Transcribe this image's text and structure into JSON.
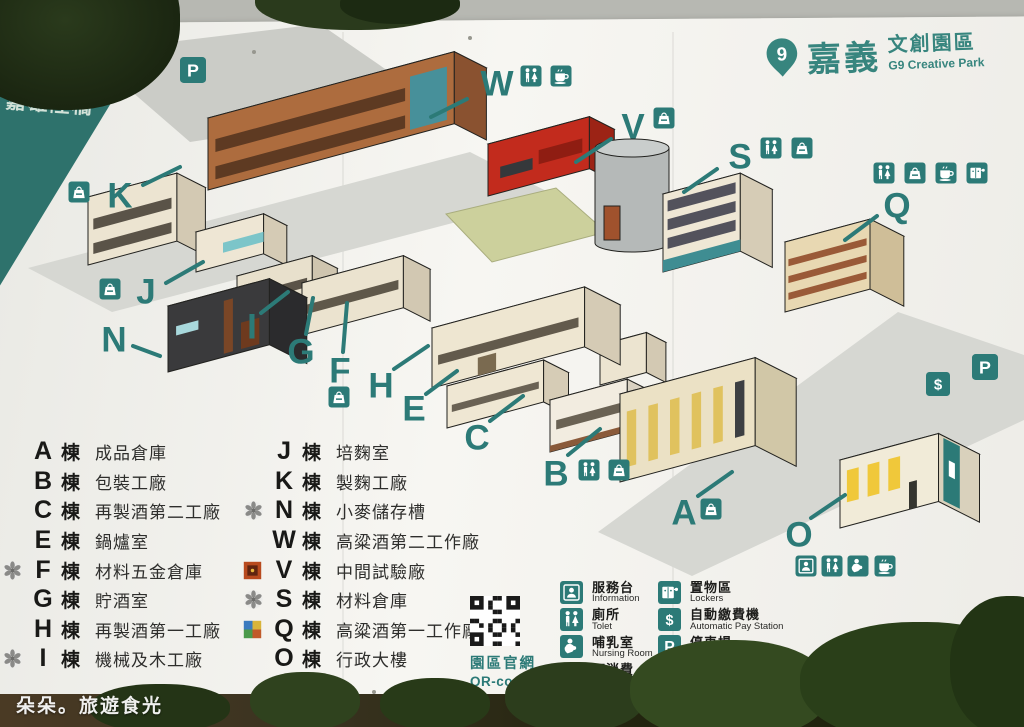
{
  "photo": {
    "watermark": "朵朵。旅遊食光"
  },
  "banners": {
    "left": "嘉雄陸橋",
    "right": "嘉義車站"
  },
  "logo": {
    "zh": "嘉義",
    "type_zh": "文創園區",
    "en": "G9 Creative Park",
    "pin_digit": "9"
  },
  "qr": {
    "zh": "園區官網",
    "en": "QR-code"
  },
  "colors": {
    "teal": "#2c7a77",
    "banner_left": "#2e726c",
    "banner_right": "#1e6f6a",
    "board": "#f4f3ef"
  },
  "legend": {
    "suffix": "棟",
    "col1": [
      {
        "letter": "A",
        "name": "成品倉庫",
        "stamp": null
      },
      {
        "letter": "B",
        "name": "包裝工廠",
        "stamp": null
      },
      {
        "letter": "C",
        "name": "再製酒第二工廠",
        "stamp": null
      },
      {
        "letter": "E",
        "name": "鍋爐室",
        "stamp": null
      },
      {
        "letter": "F",
        "name": "材料五金倉庫",
        "stamp": "flower"
      },
      {
        "letter": "G",
        "name": "貯酒室",
        "stamp": null
      },
      {
        "letter": "H",
        "name": "再製酒第一工廠",
        "stamp": null
      },
      {
        "letter": "I",
        "name": "機械及木工廠",
        "stamp": "flower"
      }
    ],
    "col2": [
      {
        "letter": "J",
        "name": "培麴室",
        "stamp": null
      },
      {
        "letter": "K",
        "name": "製麴工廠",
        "stamp": null
      },
      {
        "letter": "N",
        "name": "小麥儲存槽",
        "stamp": "flower"
      },
      {
        "letter": "W",
        "name": "高粱酒第二工作廠",
        "stamp": null
      },
      {
        "letter": "V",
        "name": "中間試驗廠",
        "stamp": "art_red"
      },
      {
        "letter": "S",
        "name": "材料倉庫",
        "stamp": "flower"
      },
      {
        "letter": "Q",
        "name": "高粱酒第一工作廠",
        "stamp": "art_color"
      },
      {
        "letter": "O",
        "name": "行政大樓",
        "stamp": null
      }
    ]
  },
  "facilities": {
    "col1": [
      {
        "icon": "info",
        "zh": "服務台",
        "en": "Information"
      },
      {
        "icon": "toilet",
        "zh": "廁所",
        "en": "Tolet"
      },
      {
        "icon": "nursing",
        "zh": "哺乳室",
        "en": "Nursing Room"
      },
      {
        "icon": "bag",
        "zh": "可消費",
        "en": "Consumable"
      }
    ],
    "col2": [
      {
        "icon": "locker",
        "zh": "置物區",
        "en": "Lockers"
      },
      {
        "icon": "dollar",
        "zh": "自動繳費機",
        "en": "Automatic Pay Station"
      },
      {
        "icon": "parking",
        "zh": "停車場",
        "en": "Parking Lot"
      },
      {
        "icon": "cup",
        "zh": "茶水間",
        "en": "Tea Room"
      }
    ]
  },
  "map": {
    "roads": [
      {
        "name": "parking-area-top-left",
        "c": "#cbccc7",
        "pts": [
          [
            86,
            52
          ],
          [
            320,
            24
          ],
          [
            436,
            104
          ],
          [
            190,
            142
          ]
        ]
      },
      {
        "name": "road-upper",
        "c": "#d6d7d2",
        "pts": [
          [
            28,
            268
          ],
          [
            470,
            152
          ],
          [
            556,
            196
          ],
          [
            112,
            312
          ]
        ]
      },
      {
        "name": "road-lower-right",
        "c": "#d6d7d2",
        "pts": [
          [
            598,
            532
          ],
          [
            898,
            312
          ],
          [
            1024,
            355
          ],
          [
            1024,
            420
          ],
          [
            692,
            576
          ]
        ]
      }
    ],
    "lawns": [
      {
        "name": "lawn-center",
        "c": "#ccd09c",
        "pts": [
          [
            446,
            214
          ],
          [
            556,
            188
          ],
          [
            606,
            232
          ],
          [
            492,
            262
          ]
        ]
      },
      {
        "name": "lawn-left",
        "c": "#ccd09c",
        "pts": [
          [
            120,
            210
          ],
          [
            165,
            198
          ],
          [
            185,
            214
          ],
          [
            138,
            228
          ]
        ]
      }
    ],
    "buildings": [
      {
        "id": "W",
        "p": [
          208,
          190
        ],
        "len": 255,
        "dep": 36,
        "h": 72,
        "front": "#ad6c3e",
        "side": "#8a5230",
        "roof": "#4b4e51",
        "details": [
          {
            "u0": 0.03,
            "u1": 0.8,
            "v0": 0.5,
            "v1": 0.68,
            "c": "#5e3a22"
          },
          {
            "u0": 0.03,
            "u1": 0.8,
            "v0": 0.12,
            "v1": 0.3,
            "c": "#5e3a22"
          },
          {
            "u0": 0.82,
            "u1": 0.97,
            "v0": 0.08,
            "v1": 0.82,
            "c": "#47909a"
          }
        ]
      },
      {
        "id": "V",
        "p": [
          488,
          196
        ],
        "len": 105,
        "dep": 28,
        "h": 52,
        "front": "#c22b1d",
        "side": "#9c2315",
        "roof": "#3a3d40",
        "details": [
          {
            "u0": 0.12,
            "u1": 0.44,
            "v0": 0.28,
            "v1": 0.5,
            "c": "#35383b"
          },
          {
            "u0": 0.5,
            "u1": 0.93,
            "v0": 0.35,
            "v1": 0.62,
            "c": "#8f1d12"
          }
        ]
      },
      {
        "id": "silo",
        "type": "silo",
        "cx": 632,
        "r": 37,
        "ry": 9,
        "top": 148,
        "bot": 243,
        "body": "#b5b9b8",
        "cap": "#c9cdcc",
        "extras": [
          {
            "x": 604,
            "y": 206,
            "w": 16,
            "h": 34,
            "c": "#a0522d"
          }
        ]
      },
      {
        "id": "K",
        "p": [
          88,
          265
        ],
        "len": 92,
        "dep": 32,
        "h": 68,
        "front": "#ece4d1",
        "side": "#d3c9b3",
        "roof": "#6b4a36",
        "details": [
          {
            "u0": 0.06,
            "u1": 0.94,
            "v0": 0.5,
            "v1": 0.66,
            "c": "#5a5348"
          },
          {
            "u0": 0.06,
            "u1": 0.94,
            "v0": 0.14,
            "v1": 0.3,
            "c": "#5a5348"
          }
        ]
      },
      {
        "id": "S",
        "p": [
          663,
          272
        ],
        "len": 80,
        "dep": 36,
        "h": 78,
        "front": "#efe7d5",
        "side": "#d6ccb6",
        "roof": "#c6bfae",
        "details": [
          {
            "u0": 0,
            "u1": 1,
            "v0": 0,
            "v1": 0.15,
            "c": "#3f8d92"
          },
          {
            "u0": 0.06,
            "u1": 0.94,
            "v0": 0.28,
            "v1": 0.42,
            "c": "#53525c"
          },
          {
            "u0": 0.06,
            "u1": 0.94,
            "v0": 0.52,
            "v1": 0.66,
            "c": "#53525c"
          },
          {
            "u0": 0.06,
            "u1": 0.94,
            "v0": 0.76,
            "v1": 0.9,
            "c": "#53525c"
          }
        ]
      },
      {
        "id": "Q",
        "p": [
          785,
          312
        ],
        "len": 88,
        "dep": 38,
        "h": 70,
        "front": "#e8d8b2",
        "side": "#cfbe98",
        "roof": "#c6bfae",
        "details": [
          {
            "u0": 0.04,
            "u1": 0.96,
            "v0": 0.16,
            "v1": 0.26,
            "c": "#9a5a38"
          },
          {
            "u0": 0.04,
            "u1": 0.96,
            "v0": 0.4,
            "v1": 0.5,
            "c": "#9a5a38"
          },
          {
            "u0": 0.04,
            "u1": 0.96,
            "v0": 0.64,
            "v1": 0.74,
            "c": "#9a5a38"
          }
        ]
      },
      {
        "id": "J",
        "p": [
          196,
          272
        ],
        "len": 70,
        "dep": 26,
        "h": 40,
        "front": "#eee6d4",
        "side": "#d5cbb5",
        "roof": "#8d9195",
        "details": [
          {
            "u0": 0.4,
            "u1": 1,
            "v0": 0.3,
            "v1": 0.55,
            "c": "#7cc5c9"
          }
        ]
      },
      {
        "id": "I",
        "p": [
          237,
          322
        ],
        "len": 78,
        "dep": 28,
        "h": 46,
        "front": "#e8e0cc",
        "side": "#cfc5af",
        "roof": "#54575a",
        "details": [
          {
            "u0": 0.07,
            "u1": 0.93,
            "v0": 0.35,
            "v1": 0.55,
            "c": "#5a5348"
          }
        ]
      },
      {
        "id": "G",
        "p": [
          302,
          335
        ],
        "len": 105,
        "dep": 30,
        "h": 52,
        "front": "#ebe3cf",
        "side": "#d2c8b2",
        "roof": "#4d5053",
        "details": [
          {
            "u0": 0.05,
            "u1": 0.95,
            "v0": 0.38,
            "v1": 0.56,
            "c": "#5f584a"
          }
        ]
      },
      {
        "id": "E",
        "p": [
          600,
          385
        ],
        "len": 48,
        "dep": 22,
        "h": 40,
        "front": "#ece4d0",
        "side": "#d3c9b3",
        "roof": "#46494c",
        "details": []
      },
      {
        "id": "N",
        "p": [
          168,
          372
        ],
        "len": 105,
        "dep": 42,
        "h": 66,
        "front": "#3a3a3c",
        "side": "#2b2b2d",
        "roof": "#454547",
        "details": [
          {
            "u0": 0.08,
            "u1": 0.3,
            "v0": 0.52,
            "v1": 0.66,
            "c": "#a8d8dc"
          },
          {
            "u0": 0.55,
            "u1": 0.64,
            "v0": 0.05,
            "v1": 0.85,
            "c": "#7a4626"
          },
          {
            "u0": 0.72,
            "u1": 0.9,
            "v0": 0.05,
            "v1": 0.45,
            "c": "#6e3a1e"
          }
        ]
      },
      {
        "id": "H",
        "p": [
          432,
          388
        ],
        "len": 158,
        "dep": 40,
        "h": 60,
        "front": "#eee6d1",
        "side": "#d5cbb5",
        "roof": "#45484b",
        "details": [
          {
            "u0": 0.04,
            "u1": 0.96,
            "v0": 0.36,
            "v1": 0.52,
            "c": "#625a4c"
          },
          {
            "u0": 0.3,
            "u1": 0.42,
            "v0": 0,
            "v1": 0.3,
            "c": "#7a6a50"
          }
        ]
      },
      {
        "id": "C",
        "p": [
          447,
          428
        ],
        "len": 100,
        "dep": 28,
        "h": 42,
        "front": "#efe7d3",
        "side": "#d6ccb6",
        "roof": "#7d756a",
        "details": [
          {
            "u0": 0.05,
            "u1": 0.95,
            "v0": 0.35,
            "v1": 0.52,
            "c": "#6a6254"
          }
        ]
      },
      {
        "id": "B",
        "p": [
          550,
          452
        ],
        "len": 80,
        "dep": 30,
        "h": 52,
        "front": "#f2ece0",
        "side": "#d9d1c1",
        "roof": "#787b7e",
        "details": [
          {
            "u0": 0,
            "u1": 1,
            "v0": 0,
            "v1": 0.12,
            "c": "#8a5a3a"
          },
          {
            "u0": 0.08,
            "u1": 0.92,
            "v0": 0.4,
            "v1": 0.58,
            "c": "#6a6254"
          }
        ]
      },
      {
        "id": "A",
        "p": [
          620,
          482
        ],
        "len": 140,
        "dep": 46,
        "h": 88,
        "front": "#ebe1c5",
        "side": "#d1c7a7",
        "roof": "#52555a",
        "details": [
          {
            "u0": 0.05,
            "u1": 0.12,
            "v0": 0.15,
            "v1": 0.78,
            "c": "#e0c25e"
          },
          {
            "u0": 0.21,
            "u1": 0.28,
            "v0": 0.15,
            "v1": 0.78,
            "c": "#e0c25e"
          },
          {
            "u0": 0.37,
            "u1": 0.44,
            "v0": 0.15,
            "v1": 0.78,
            "c": "#e0c25e"
          },
          {
            "u0": 0.53,
            "u1": 0.6,
            "v0": 0.15,
            "v1": 0.78,
            "c": "#e0c25e"
          },
          {
            "u0": 0.69,
            "u1": 0.76,
            "v0": 0.15,
            "v1": 0.78,
            "c": "#e0c25e"
          },
          {
            "u0": 0.85,
            "u1": 0.92,
            "v0": 0.15,
            "v1": 0.78,
            "c": "#3d3f42"
          }
        ]
      },
      {
        "id": "O",
        "p": [
          840,
          528
        ],
        "len": 102,
        "dep": 46,
        "h": 68,
        "front": "#f1ebd8",
        "side": "#d9d1bc",
        "roof": "#e9e5d7",
        "details": [
          {
            "u0": 0.07,
            "u1": 0.19,
            "v0": 0.35,
            "v1": 0.82,
            "c": "#f0c83a"
          },
          {
            "u0": 0.28,
            "u1": 0.4,
            "v0": 0.35,
            "v1": 0.82,
            "c": "#f0c83a"
          },
          {
            "u0": 0.49,
            "u1": 0.61,
            "v0": 0.35,
            "v1": 0.82,
            "c": "#f0c83a"
          },
          {
            "u0": 0.7,
            "u1": 0.78,
            "v0": 0,
            "v1": 0.4,
            "c": "#35352f"
          }
        ],
        "sideDetails": [
          {
            "u0": 0.12,
            "u1": 0.52,
            "v0": 0.05,
            "v1": 0.97,
            "c": "#2c7a77"
          },
          {
            "u0": 0.25,
            "u1": 0.4,
            "v0": 0.45,
            "v1": 0.68,
            "c": "#ffffff"
          }
        ]
      }
    ],
    "markers": [
      {
        "letter": "W",
        "x": 497,
        "y": 84,
        "line": [
          467,
          99,
          431,
          117
        ],
        "icons": [
          {
            "type": "toilet",
            "x": 531,
            "y": 76
          },
          {
            "type": "cup",
            "x": 561,
            "y": 76
          }
        ]
      },
      {
        "letter": "V",
        "x": 633,
        "y": 127,
        "line": [
          611,
          139,
          576,
          162
        ],
        "icons": [
          {
            "type": "bag",
            "x": 664,
            "y": 118
          }
        ]
      },
      {
        "letter": "S",
        "x": 740,
        "y": 157,
        "line": [
          717,
          169,
          684,
          192
        ],
        "icons": [
          {
            "type": "toilet",
            "x": 771,
            "y": 148
          },
          {
            "type": "bag",
            "x": 802,
            "y": 148
          }
        ]
      },
      {
        "letter": "Q",
        "x": 897,
        "y": 206,
        "line": [
          877,
          216,
          845,
          240
        ],
        "icons": [
          {
            "type": "toilet",
            "x": 884,
            "y": 173
          },
          {
            "type": "bag",
            "x": 915,
            "y": 173
          },
          {
            "type": "cup",
            "x": 946,
            "y": 173
          },
          {
            "type": "locker",
            "x": 977,
            "y": 173
          }
        ]
      },
      {
        "letter": "K",
        "x": 120,
        "y": 196,
        "line": [
          143,
          185,
          180,
          167
        ],
        "icons": [
          {
            "type": "bag",
            "x": 79,
            "y": 192
          }
        ]
      },
      {
        "letter": "J",
        "x": 146,
        "y": 292,
        "line": [
          166,
          283,
          203,
          262
        ],
        "icons": [
          {
            "type": "bag",
            "x": 110,
            "y": 289
          }
        ]
      },
      {
        "letter": "N",
        "x": 114,
        "y": 340,
        "line": [
          133,
          346,
          160,
          356
        ],
        "icons": []
      },
      {
        "letter": "I",
        "x": 252,
        "y": 327,
        "line": [
          261,
          313,
          288,
          292
        ],
        "icons": []
      },
      {
        "letter": "G",
        "x": 301,
        "y": 352,
        "line": [
          306,
          334,
          313,
          298
        ],
        "icons": []
      },
      {
        "letter": "F",
        "x": 340,
        "y": 371,
        "line": [
          343,
          352,
          347,
          303
        ],
        "icons": [
          {
            "type": "bag",
            "x": 339,
            "y": 397
          }
        ]
      },
      {
        "letter": "H",
        "x": 381,
        "y": 386,
        "line": [
          394,
          369,
          428,
          346
        ],
        "icons": []
      },
      {
        "letter": "E",
        "x": 414,
        "y": 409,
        "line": [
          426,
          394,
          457,
          371
        ],
        "icons": []
      },
      {
        "letter": "C",
        "x": 477,
        "y": 438,
        "line": [
          490,
          421,
          523,
          396
        ],
        "icons": []
      },
      {
        "letter": "B",
        "x": 556,
        "y": 474,
        "line": [
          568,
          455,
          600,
          429
        ],
        "icons": [
          {
            "type": "toilet",
            "x": 589,
            "y": 470
          },
          {
            "type": "bag",
            "x": 619,
            "y": 470
          }
        ]
      },
      {
        "letter": "A",
        "x": 684,
        "y": 513,
        "line": [
          698,
          496,
          732,
          472
        ],
        "icons": [
          {
            "type": "bag",
            "x": 711,
            "y": 509
          }
        ]
      },
      {
        "letter": "O",
        "x": 799,
        "y": 535,
        "line": [
          811,
          518,
          845,
          495
        ],
        "icons": [
          {
            "type": "info",
            "x": 806,
            "y": 566
          },
          {
            "type": "toilet",
            "x": 832,
            "y": 566
          },
          {
            "type": "nursing",
            "x": 858,
            "y": 566
          },
          {
            "type": "cup",
            "x": 885,
            "y": 566
          }
        ]
      }
    ],
    "badges": [
      {
        "type": "parking",
        "x": 193,
        "y": 70,
        "size": 26
      },
      {
        "type": "dollar",
        "x": 938,
        "y": 384,
        "size": 24
      },
      {
        "type": "parking",
        "x": 985,
        "y": 367,
        "size": 26
      }
    ]
  }
}
